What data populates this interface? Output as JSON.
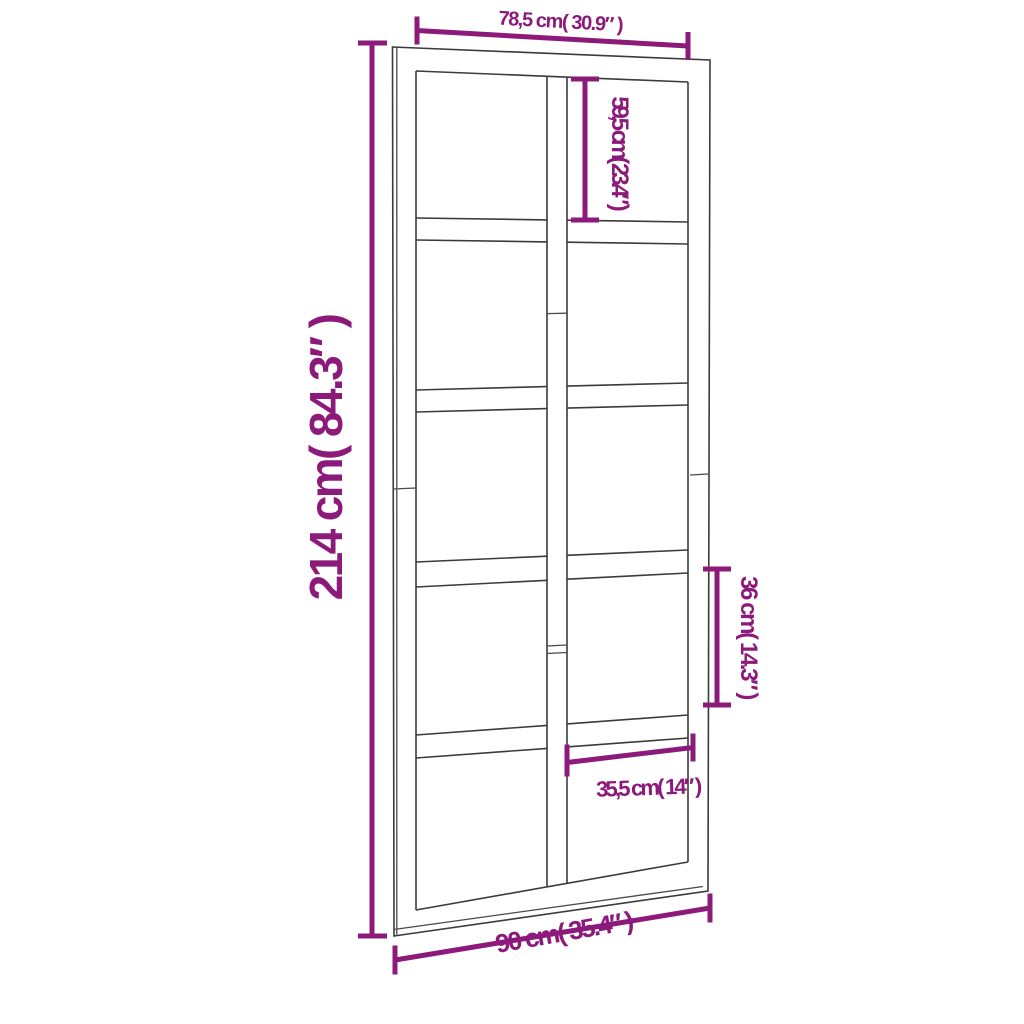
{
  "diagram": {
    "figure_name": "door-with-ten-glass-panes-dimension-diagram",
    "colors": {
      "background": "#ffffff",
      "door_outline": "#3b3b3b",
      "dimension_accent": "#8c1a7b"
    },
    "dimensions": {
      "top_inner_width": "78,5 cm( 30.9″ )",
      "upper_pane_height": "59,5 cm( 23.4″ )",
      "overall_height": "214 cm( 84.3″ )",
      "right_pane_height": "36 cm( 14.3″ )",
      "bottom_pane_width": "35,5 cm( 14″ )",
      "overall_width": "90 cm( 35.4″ )"
    }
  }
}
